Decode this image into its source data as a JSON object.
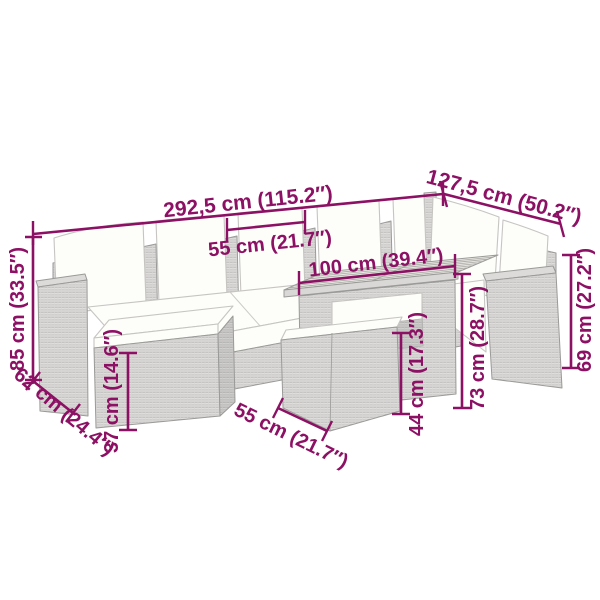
{
  "diagram": {
    "type": "product-dimension-diagram",
    "subject": "Poly rattan garden lounge set with cushions, ottomans and wood-top table",
    "accent_color": "#8C1063",
    "rattan_color": "#e4e3e1",
    "cushion_color": "#fdfdfa",
    "background_color": "#ffffff"
  },
  "dimensions": {
    "total_width": {
      "label": "292,5 cm (115.2″)",
      "cm": 292.5,
      "inches": 115.2
    },
    "right_section_depth": {
      "label": "127,5 cm (50.2″)",
      "cm": 127.5,
      "inches": 50.2
    },
    "seat_width": {
      "label": "55 cm (21.7″)",
      "cm": 55,
      "inches": 21.7
    },
    "table_length": {
      "label": "100 cm (39.4″)",
      "cm": 100,
      "inches": 39.4
    },
    "total_height": {
      "label": "85 cm (33.5″)",
      "cm": 85,
      "inches": 33.5
    },
    "seat_depth": {
      "label": "62 cm (24.4″)",
      "cm": 62,
      "inches": 24.4
    },
    "ottoman_height": {
      "label": "37 cm (14.6″)",
      "cm": 37,
      "inches": 14.6
    },
    "ottoman_width": {
      "label": "55 cm (21.7″)",
      "cm": 55,
      "inches": 21.7
    },
    "stool_height": {
      "label": "44 cm (17.3″)",
      "cm": 44,
      "inches": 17.3
    },
    "table_height": {
      "label": "73 cm (28.7″)",
      "cm": 73,
      "inches": 28.7
    },
    "armrest_height": {
      "label": "69 cm (27.2″)",
      "cm": 69,
      "inches": 27.2
    }
  }
}
